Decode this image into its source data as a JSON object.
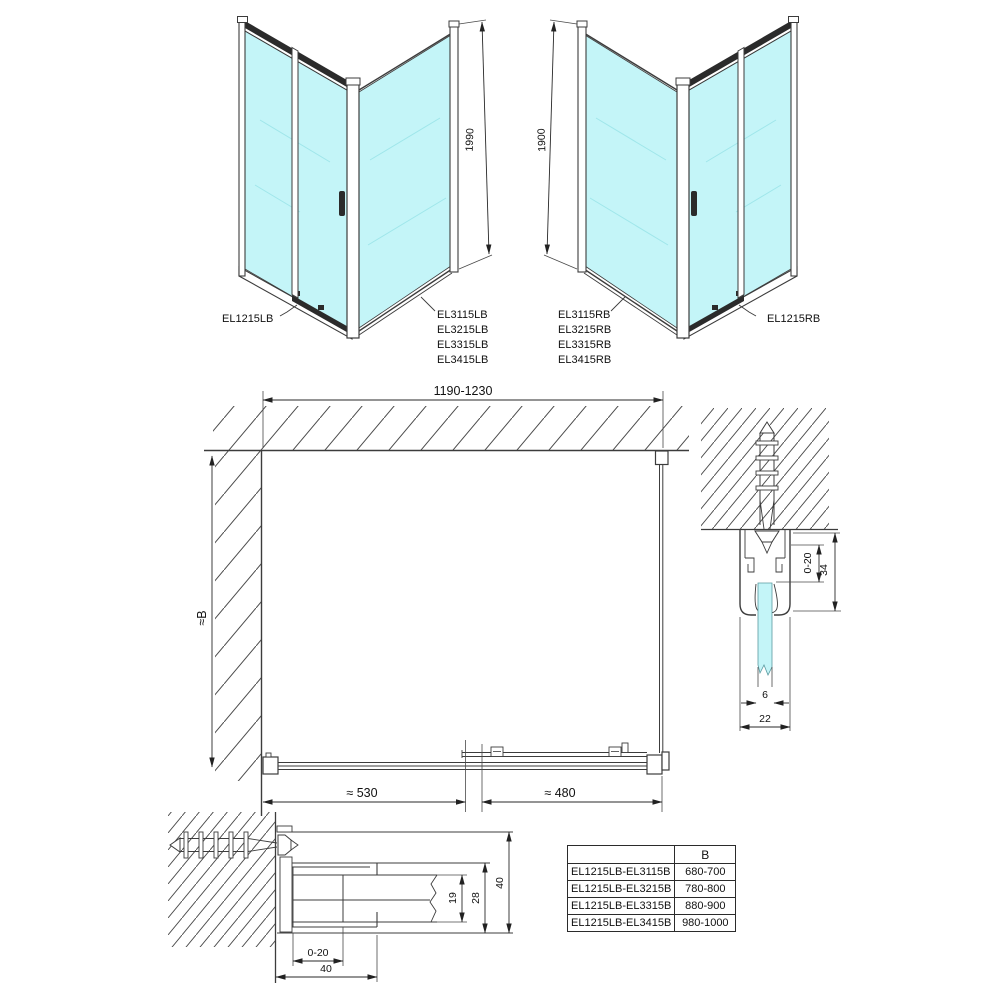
{
  "colors": {
    "glass": "#c4f5f8",
    "line": "#3c3c3c"
  },
  "left_view": {
    "door_label": "EL1215LB",
    "panel_labels": [
      "EL3115LB",
      "EL3215LB",
      "EL3315LB",
      "EL3415LB"
    ],
    "height_dim": "1990"
  },
  "right_view": {
    "door_label": "EL1215RB",
    "panel_labels": [
      "EL3115RB",
      "EL3215RB",
      "EL3315RB",
      "EL3415RB"
    ],
    "height_dim": "1900"
  },
  "plan": {
    "width_dim": "1190-1230",
    "depth_dim": "≈B",
    "fixed_segment_dim": "≈ 530",
    "door_segment_dim": "≈ 480"
  },
  "wall_section": {
    "adjust_dim": "0-20",
    "profile_height_dim": "34",
    "glass_thickness_dim": "6",
    "profile_width_dim": "22"
  },
  "floor_section": {
    "adjust_dim": "0-20",
    "bottom_width_dim": "40",
    "pocket_dim": "19",
    "inner_dim": "28",
    "depth_dim": "40"
  },
  "size_table": {
    "header_b": "B",
    "rows": [
      {
        "combo": "EL1215LB-EL3115B",
        "b": "680-700"
      },
      {
        "combo": "EL1215LB-EL3215B",
        "b": "780-800"
      },
      {
        "combo": "EL1215LB-EL3315B",
        "b": "880-900"
      },
      {
        "combo": "EL1215LB-EL3415B",
        "b": "980-1000"
      }
    ]
  }
}
